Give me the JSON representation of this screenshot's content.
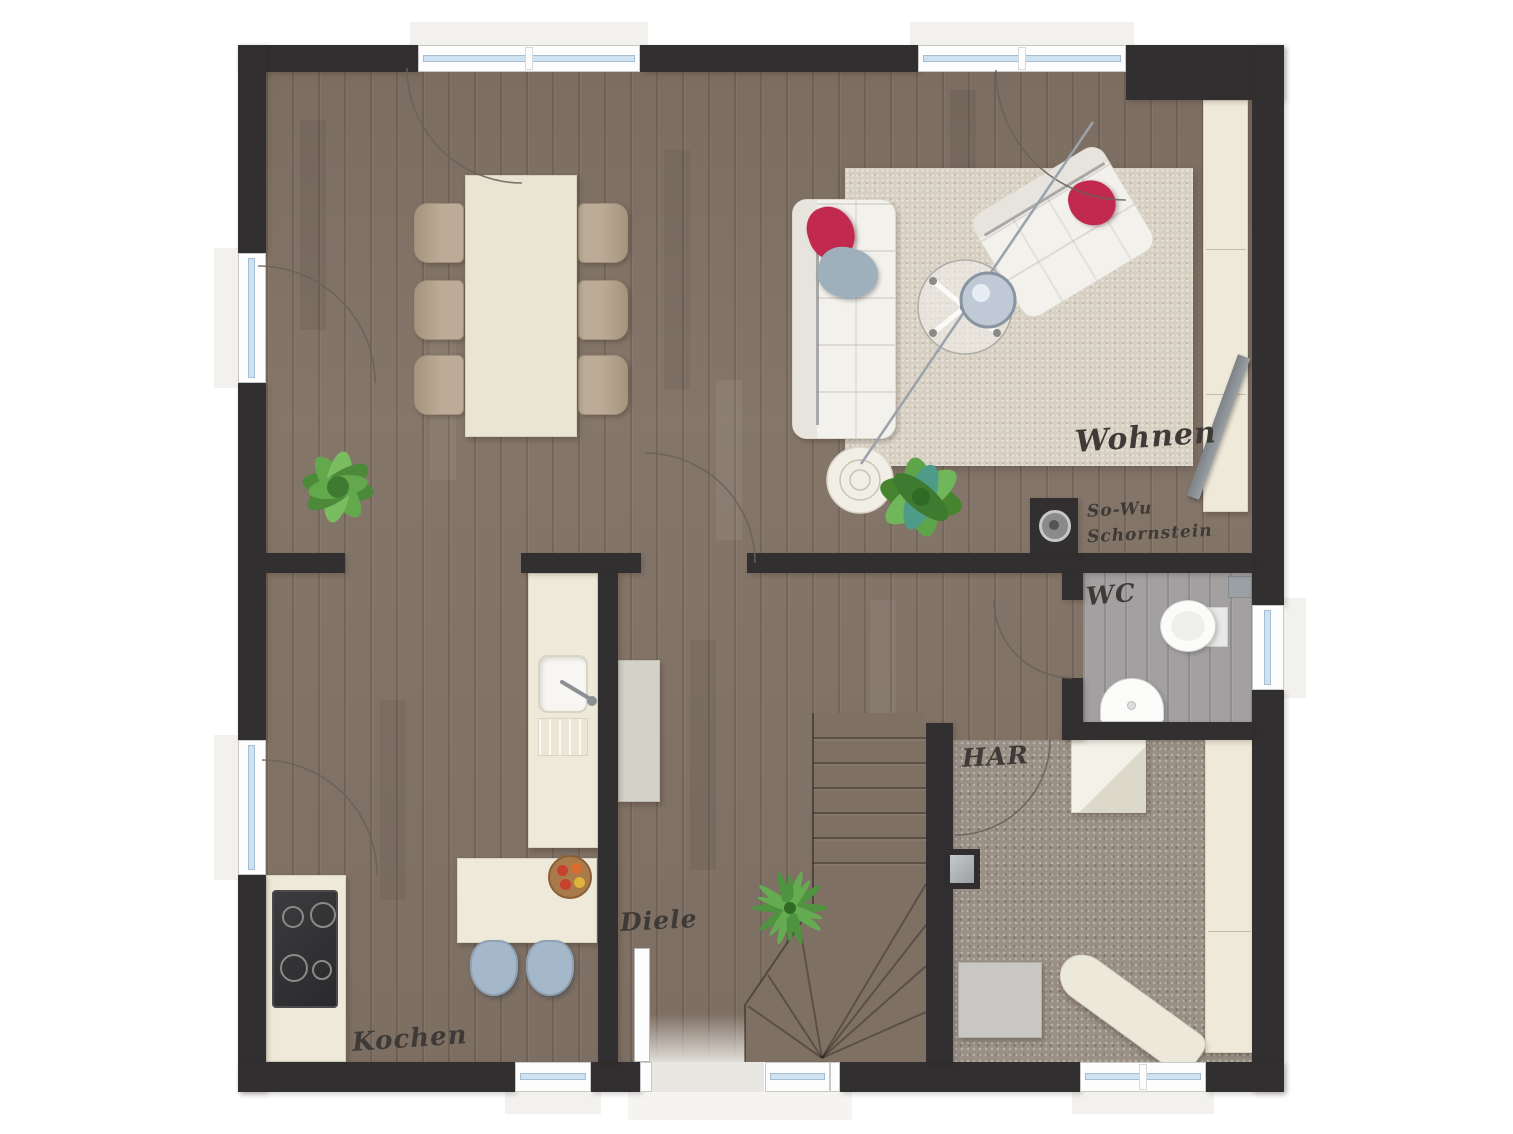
{
  "plan": {
    "labels": {
      "wohnen": "Wohnen",
      "kochen": "Kochen",
      "diele": "Diele",
      "wc": "WC",
      "har": "HAR",
      "chimney_line1": "So-Wu",
      "chimney_line2": "Schornstein"
    },
    "colors": {
      "wall": "#322f30",
      "wood_floor": "#87786c",
      "wc_floor": "#a3a0a1",
      "har_carpet": "#9a9085",
      "stair_wood": "#7f7064",
      "rug": "#d7d0c2",
      "cream_furniture": "#efe9d9",
      "pillow_red": "#c1294e",
      "pillow_gray": "#9fb0bd",
      "glass_blue": "#cfe2f2",
      "stool_blue": "#a4b8ca",
      "plant_green": "#5da247",
      "label_ink": "#3e3a37"
    }
  }
}
